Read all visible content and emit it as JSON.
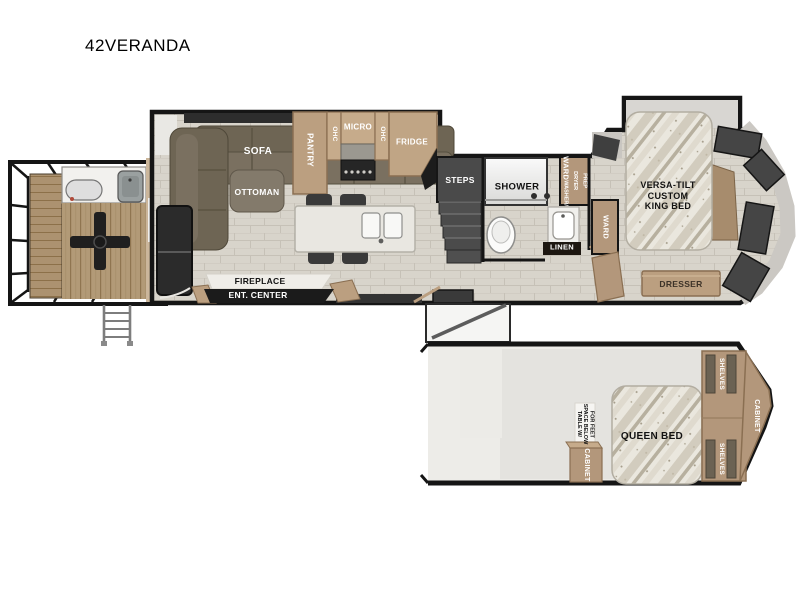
{
  "title": "42VERANDA",
  "colors": {
    "wall": "#151515",
    "cabinet_tan": "#b3977b",
    "cabinet_tan_light": "#c6ab8b",
    "floor_plank": "#d8d4cc",
    "deck_wood": "#b59c79",
    "sofa": "#6e6554",
    "window": "#3d3d3d",
    "unit_black": "#1b1b1b",
    "loft_floor": "#e5e4e0"
  },
  "main_level": {
    "living": {
      "sofa": "SOFA",
      "ottoman": "OTTOMAN",
      "fireplace": "FIREPLACE",
      "ent_center": "ENT. CENTER"
    },
    "kitchen": {
      "pantry": "PANTRY",
      "ohc_left": "OHC",
      "micro": "MICRO",
      "ohc_right": "OHC",
      "fridge": "FRIDGE"
    },
    "stairs": {
      "steps": "STEPS"
    },
    "bath": {
      "shower": "SHOWER",
      "ward_wd": "WARD",
      "wd_prep": "WASHER/\nDRYER\nPREP",
      "linen": "LINEN"
    },
    "bedroom": {
      "ward": "WARD",
      "king_bed": "VERSA-TILT\nCUSTOM\nKING BED",
      "dresser": "DRESSER"
    }
  },
  "loft_level": {
    "table_note": "TABLE W/\nSPACE BELOW\nFOR FEET",
    "cabinet_front": "CABINET",
    "queen_bed": "QUEEN BED",
    "shelves_top": "SHELVES",
    "shelves_bottom": "SHELVES",
    "cabinet_rear": "CABINET"
  }
}
